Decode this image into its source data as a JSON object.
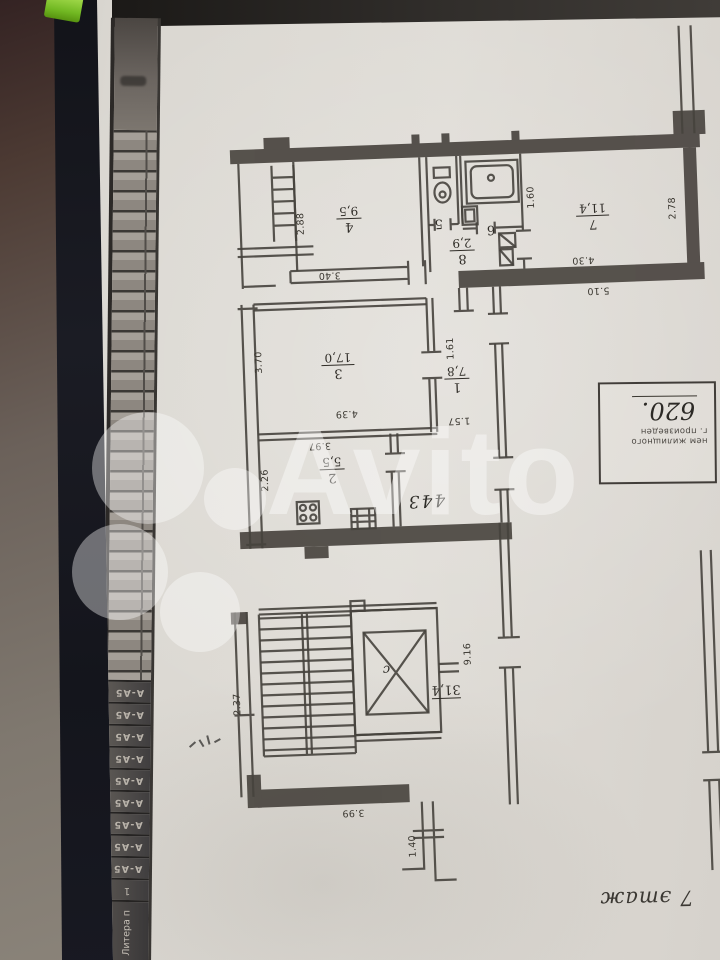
{
  "watermark": {
    "brand": "Avito"
  },
  "page": {
    "floor_label": "7 этаж",
    "binding_cells": [
      "А-А5",
      "А-А5",
      "А-А5",
      "А-А5",
      "А-А5",
      "А-А5",
      "А-А5",
      "А-А5",
      "А-А5"
    ],
    "binding_row_end": "1",
    "binding_caption": "Литера п"
  },
  "plan": {
    "apartment_number": "443",
    "elevator_letter": "с",
    "corridor_area": "31,4",
    "rooms": {
      "r1": {
        "number": "1",
        "area": "7,8"
      },
      "r2": {
        "number": "2",
        "area": "5,5"
      },
      "r3": {
        "number": "3",
        "area": "17,0"
      },
      "r4": {
        "number": "4",
        "area": "9,5"
      },
      "r5": {
        "number": "5"
      },
      "r6": {
        "number": "6"
      },
      "r7": {
        "number": "7",
        "area": "11,4"
      },
      "r8": {
        "number": "8",
        "area": "2,9"
      }
    },
    "dimensions": {
      "d340": "3.40",
      "d288": "2.88",
      "d160": "1.60",
      "d430": "4.30",
      "d278": "2.78",
      "d510": "5.10",
      "d370": "3.70",
      "d439": "4.39",
      "d397": "3.97",
      "d161": "1.61",
      "d157": "1.57",
      "d226": "2.26",
      "d237": "2.37",
      "d916": "9.16",
      "d399": "3.99",
      "d140": "1.40"
    },
    "stamp": {
      "line1": "нем жилищного",
      "line2": "г. произведен",
      "number": "620."
    }
  }
}
